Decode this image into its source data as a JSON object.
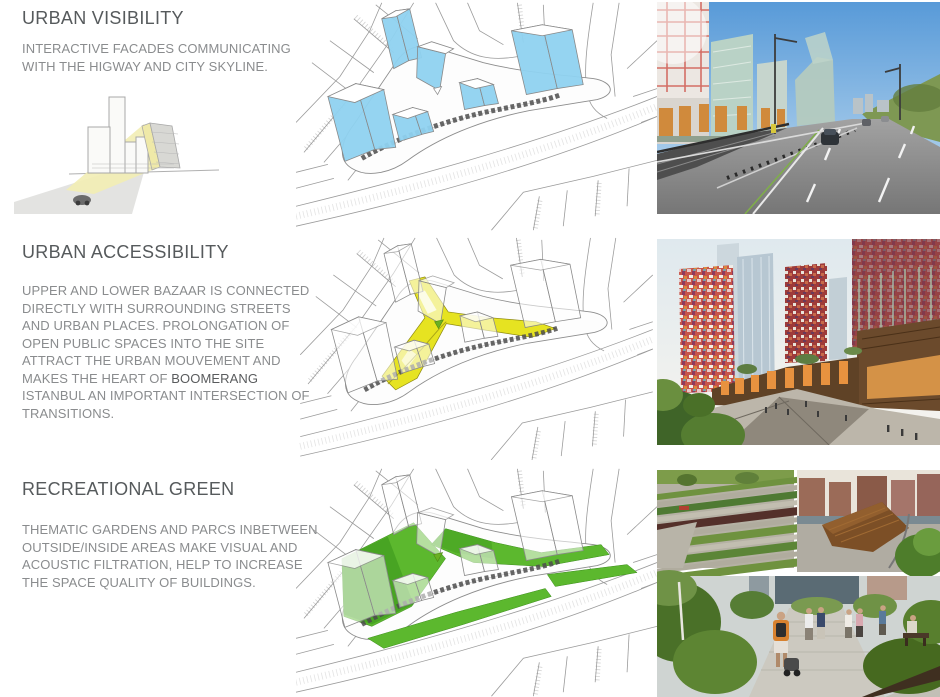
{
  "sections": [
    {
      "title": "URBAN VISIBILITY",
      "body": "INTERACTIVE FACADES COMMUNICATING WITH THE HIGWAY AND CITY SKYLINE."
    },
    {
      "title": "URBAN ACCESSIBILITY",
      "body_parts": [
        "UPPER AND LOWER BAZAAR IS CONNECTED DIRECTLY WITH  SURROUNDING STREETS AND URBAN PLACES. PROLONGATION OF OPEN PUBLIC SPACES INTO THE SITE ATTRACT THE URBAN MOUVEMENT AND MAKES THE HEART OF ",
        "BOOMERANG",
        " ISTANBUL AN IMPORTANT INTERSECTION OF TRANSITIONS."
      ]
    },
    {
      "title": "RECREATIONAL GREEN",
      "body": "THEMATIC GARDENS AND PARCS INBETWEEN OUTSIDE/INSIDE AREAS MAKE VISUAL AND ACOUSTIC FILTRATION, HELP TO INCREASE THE SPACE QUALITY OF BUILDINGS."
    }
  ],
  "colors": {
    "title_text": "#565a5c",
    "body_text": "#8a8c8e",
    "emphasis_text": "#595b5d",
    "diagram_line": "#9b9b9b",
    "diagram_blue": "#8fd2f0",
    "diagram_yellow": "#e6e321",
    "diagram_green": "#5cb82e",
    "diagram_green_dark": "#44a021",
    "sketch_beam_yellow": "#f2edb4"
  }
}
